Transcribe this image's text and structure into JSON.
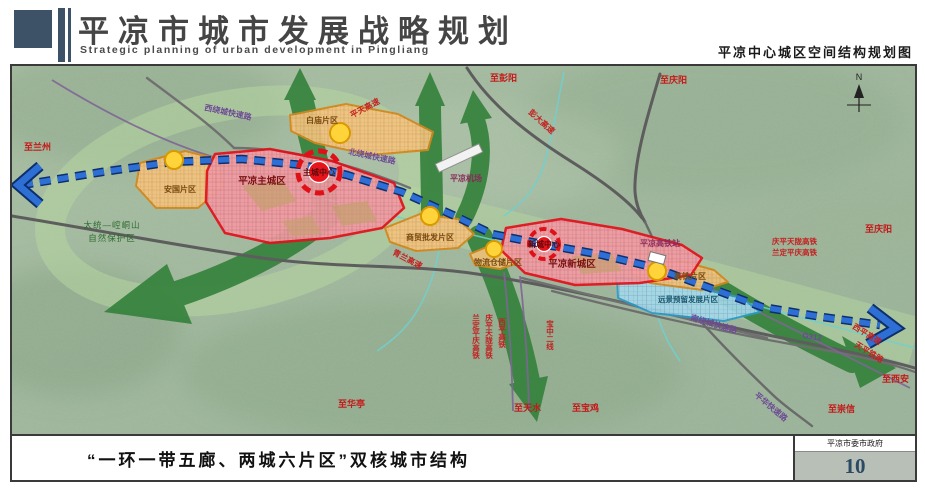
{
  "header": {
    "title": "平凉市城市发展战略规划",
    "subtitle": "Strategic planning of urban development in Pingliang",
    "map_title": "平凉中心城区空间结构规划图"
  },
  "footer": {
    "caption": "“一环一带五廊、两城六片区”双核城市结构",
    "agency": "平凉市委市政府",
    "page_number": "10"
  },
  "map": {
    "compass": "N",
    "districts": {
      "main_city": "平凉主城区",
      "main_center": "主城中心",
      "new_city": "平凉新城区",
      "new_center": "新城中心",
      "anguo": "安国片区",
      "baimiao": "白庙片区",
      "shangmao": "商贸批发片区",
      "wuliu": "物流仓储片区",
      "gaotie": "高铁片区",
      "reserved": "远景预留发展片区"
    },
    "pois": {
      "airport": "平凉机场",
      "hsr_station": "平凉高铁站",
      "nature_reserve_line1": "太统—崆峒山",
      "nature_reserve_line2": "自然保护区"
    },
    "roads": {
      "pengda": "彭大高速",
      "pingtian": "平天高速",
      "qinglan": "青兰高速",
      "xiping_expwy": "西平高速",
      "tianping_rail": "天平铁路",
      "west_ring": "西绕城快速路",
      "north_ring": "北绕城快速路",
      "south_ring": "南绕城快速路",
      "g312": "G312",
      "pinghua": "平华快速路"
    },
    "railways": {
      "qingping_tianlong": "庆平天陇高铁",
      "landing_pingqing": "兰定平庆高铁",
      "xiping_hsr": "西平高铁",
      "baozhong": "宝中二线"
    },
    "destinations": {
      "lanzhou": "至兰州",
      "pengyang": "至彭阳",
      "qingyang_n": "至庆阳",
      "qingyang_e": "至庆阳",
      "xian": "至西安",
      "chongxin": "至崇信",
      "baoji": "至宝鸡",
      "tianshui": "至天水",
      "huating": "至华亭"
    }
  },
  "colors": {
    "corridor_green": "#35813c",
    "eco_band": "#b6d6a0",
    "rail_blue": "#2e6fd6",
    "district_red": "#e3111c",
    "district_orange": "#d4881c",
    "reserved_blue": "#2b9cc9"
  }
}
